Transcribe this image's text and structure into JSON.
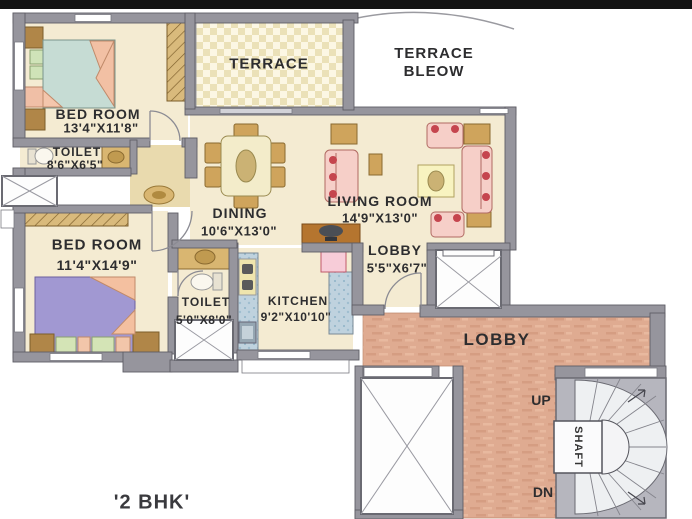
{
  "title": "'2 BHK'",
  "rooms": {
    "bedroom1": {
      "name": "BED ROOM",
      "dims": "13'4\"X11'8\""
    },
    "toilet1": {
      "name": "TOILET",
      "dims": "8'6\"X6'5\""
    },
    "bedroom2": {
      "name": "BED ROOM",
      "dims": "11'4\"X14'9\""
    },
    "toilet2": {
      "name": "TOILET",
      "dims": "5'0\"X8'0\""
    },
    "kitchen": {
      "name": "KITCHEN",
      "dims": "9'2\"X10'10\""
    },
    "dining": {
      "name": "DINING",
      "dims": "10'6\"X13'0\""
    },
    "living": {
      "name": "LIVING ROOM",
      "dims": "14'9\"X13'0\""
    },
    "lobby_inner": {
      "name": "LOBBY",
      "dims": "5'5\"X6'7\""
    },
    "terrace": {
      "name": "TERRACE"
    },
    "terrace_below": {
      "line1": "TERRACE",
      "line2": "BLEOW"
    },
    "lobby_common": {
      "name": "LOBBY"
    }
  },
  "stairs": {
    "up": "UP",
    "down": "DN",
    "shaft": "SHAFT"
  },
  "colors": {
    "wall": "#96959d",
    "floor_cream": "#f4ebd2",
    "lobby_salmon": "#dfab91",
    "kitchen_counter": "#bfd2de",
    "sofa_pink": "#f6cfc8",
    "bed_teal": "#c6dcd4",
    "bed_purple": "#a198d2",
    "furniture_tan": "#cfa45c",
    "text": "#2d2d2f"
  }
}
